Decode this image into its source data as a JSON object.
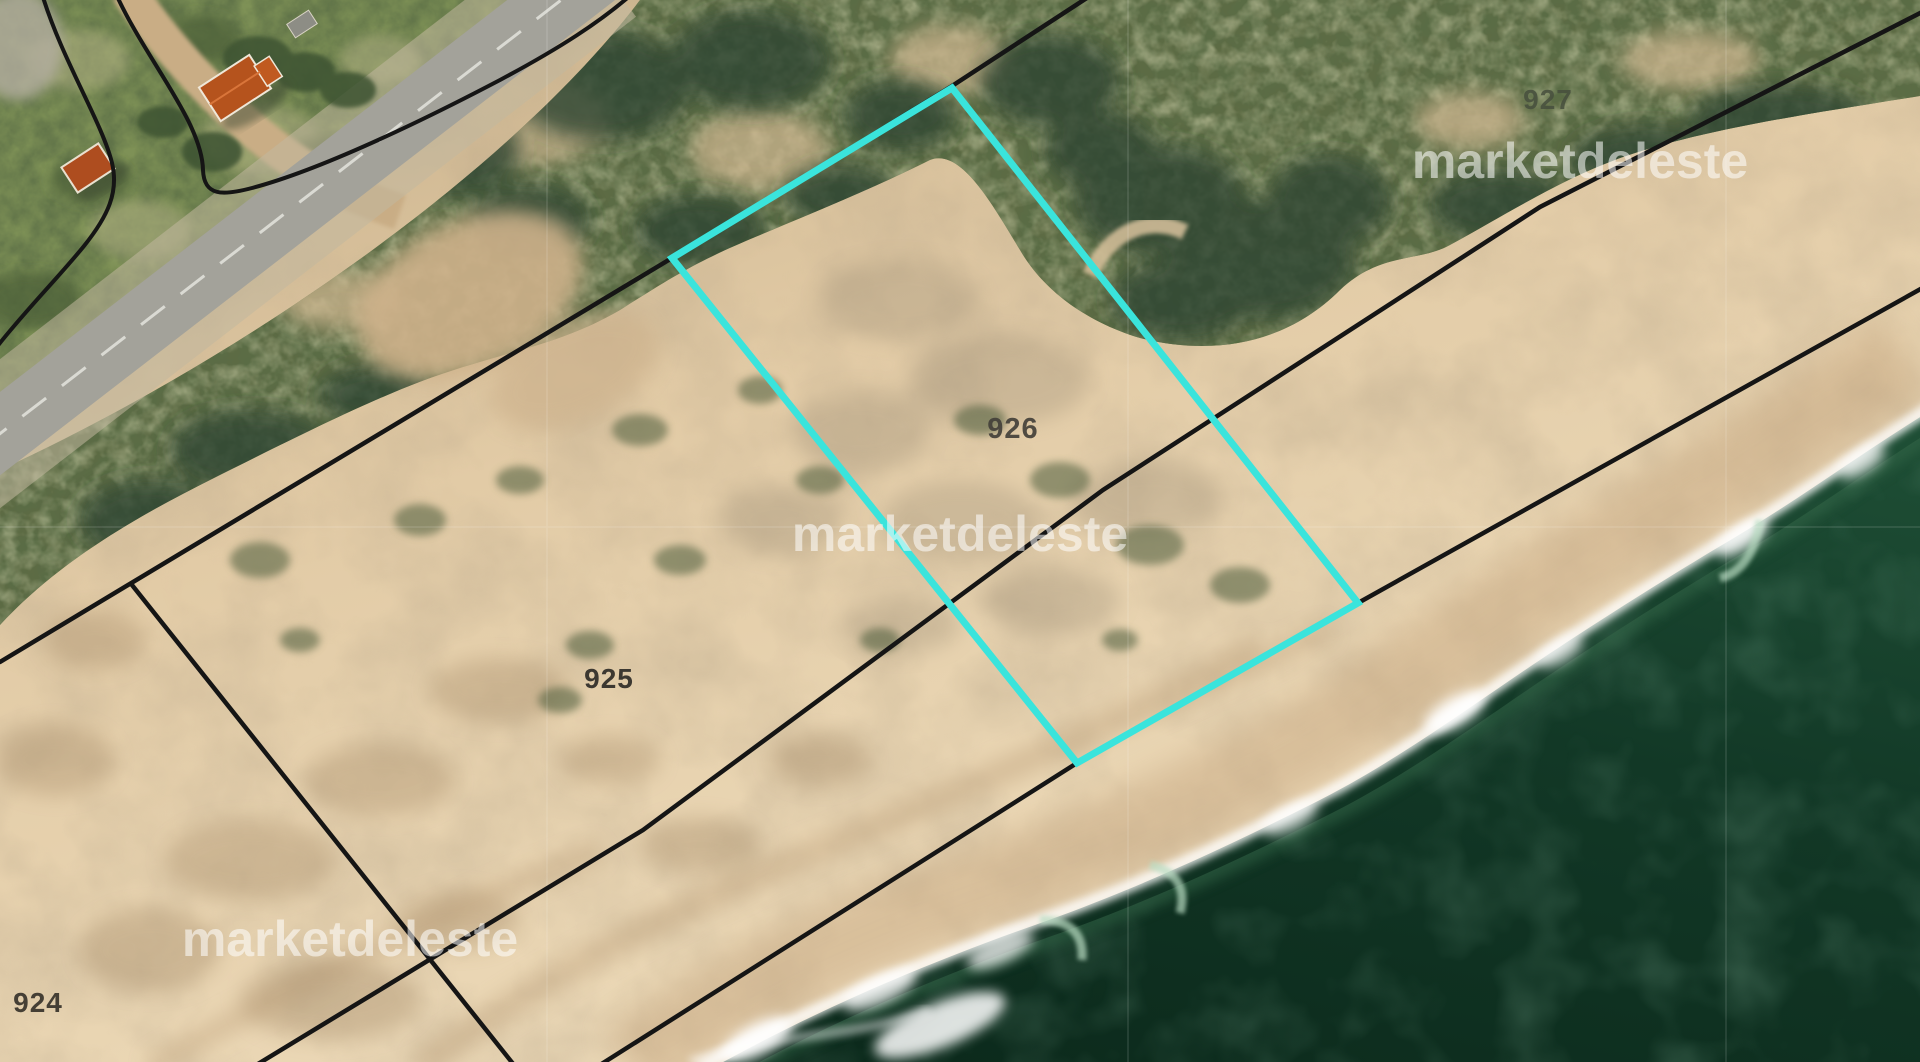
{
  "map": {
    "description": "satellite-parcel-map-beachfront",
    "parcels": [
      {
        "id": "924",
        "label": "924",
        "highlighted": false
      },
      {
        "id": "925",
        "label": "925",
        "highlighted": false
      },
      {
        "id": "926",
        "label": "926",
        "highlighted": true
      },
      {
        "id": "927",
        "label": "927",
        "highlighted": false
      }
    ],
    "colors": {
      "highlight": "#3ae4dc",
      "boundary": "#151515",
      "label": "#413c34",
      "ocean_deep": "#0c2a1c",
      "ocean_shore": "#1e4e35",
      "sand_light": "#eedcbb",
      "sand_dark": "#c9b28c",
      "vegetation": "#57663f",
      "grass": "#7e9156",
      "road": "#a3a29a",
      "roof": "#b5531d",
      "foam": "#ffffff"
    }
  },
  "watermark": {
    "text": "marketdeleste",
    "color": "#ffffff",
    "opacity": "0.55"
  }
}
